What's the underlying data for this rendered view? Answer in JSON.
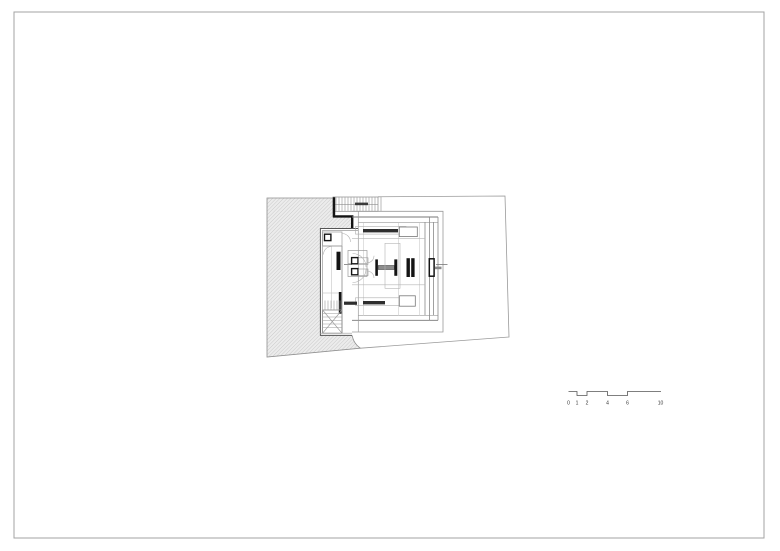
{
  "page": {
    "background": "#ffffff",
    "border_color": "#a3a3a3"
  },
  "drawing": {
    "hatch_fill": "#ececec",
    "hatch_line_color": "#b8b8b8",
    "thin_line_color": "#9a9a9a",
    "medium_line_color": "#6f6f6f",
    "wall_color": "#141414",
    "furniture_fill": "#2e2e2e"
  },
  "scale_bar": {
    "labels": [
      "0",
      "1",
      "2",
      "4",
      "6",
      "10"
    ]
  }
}
